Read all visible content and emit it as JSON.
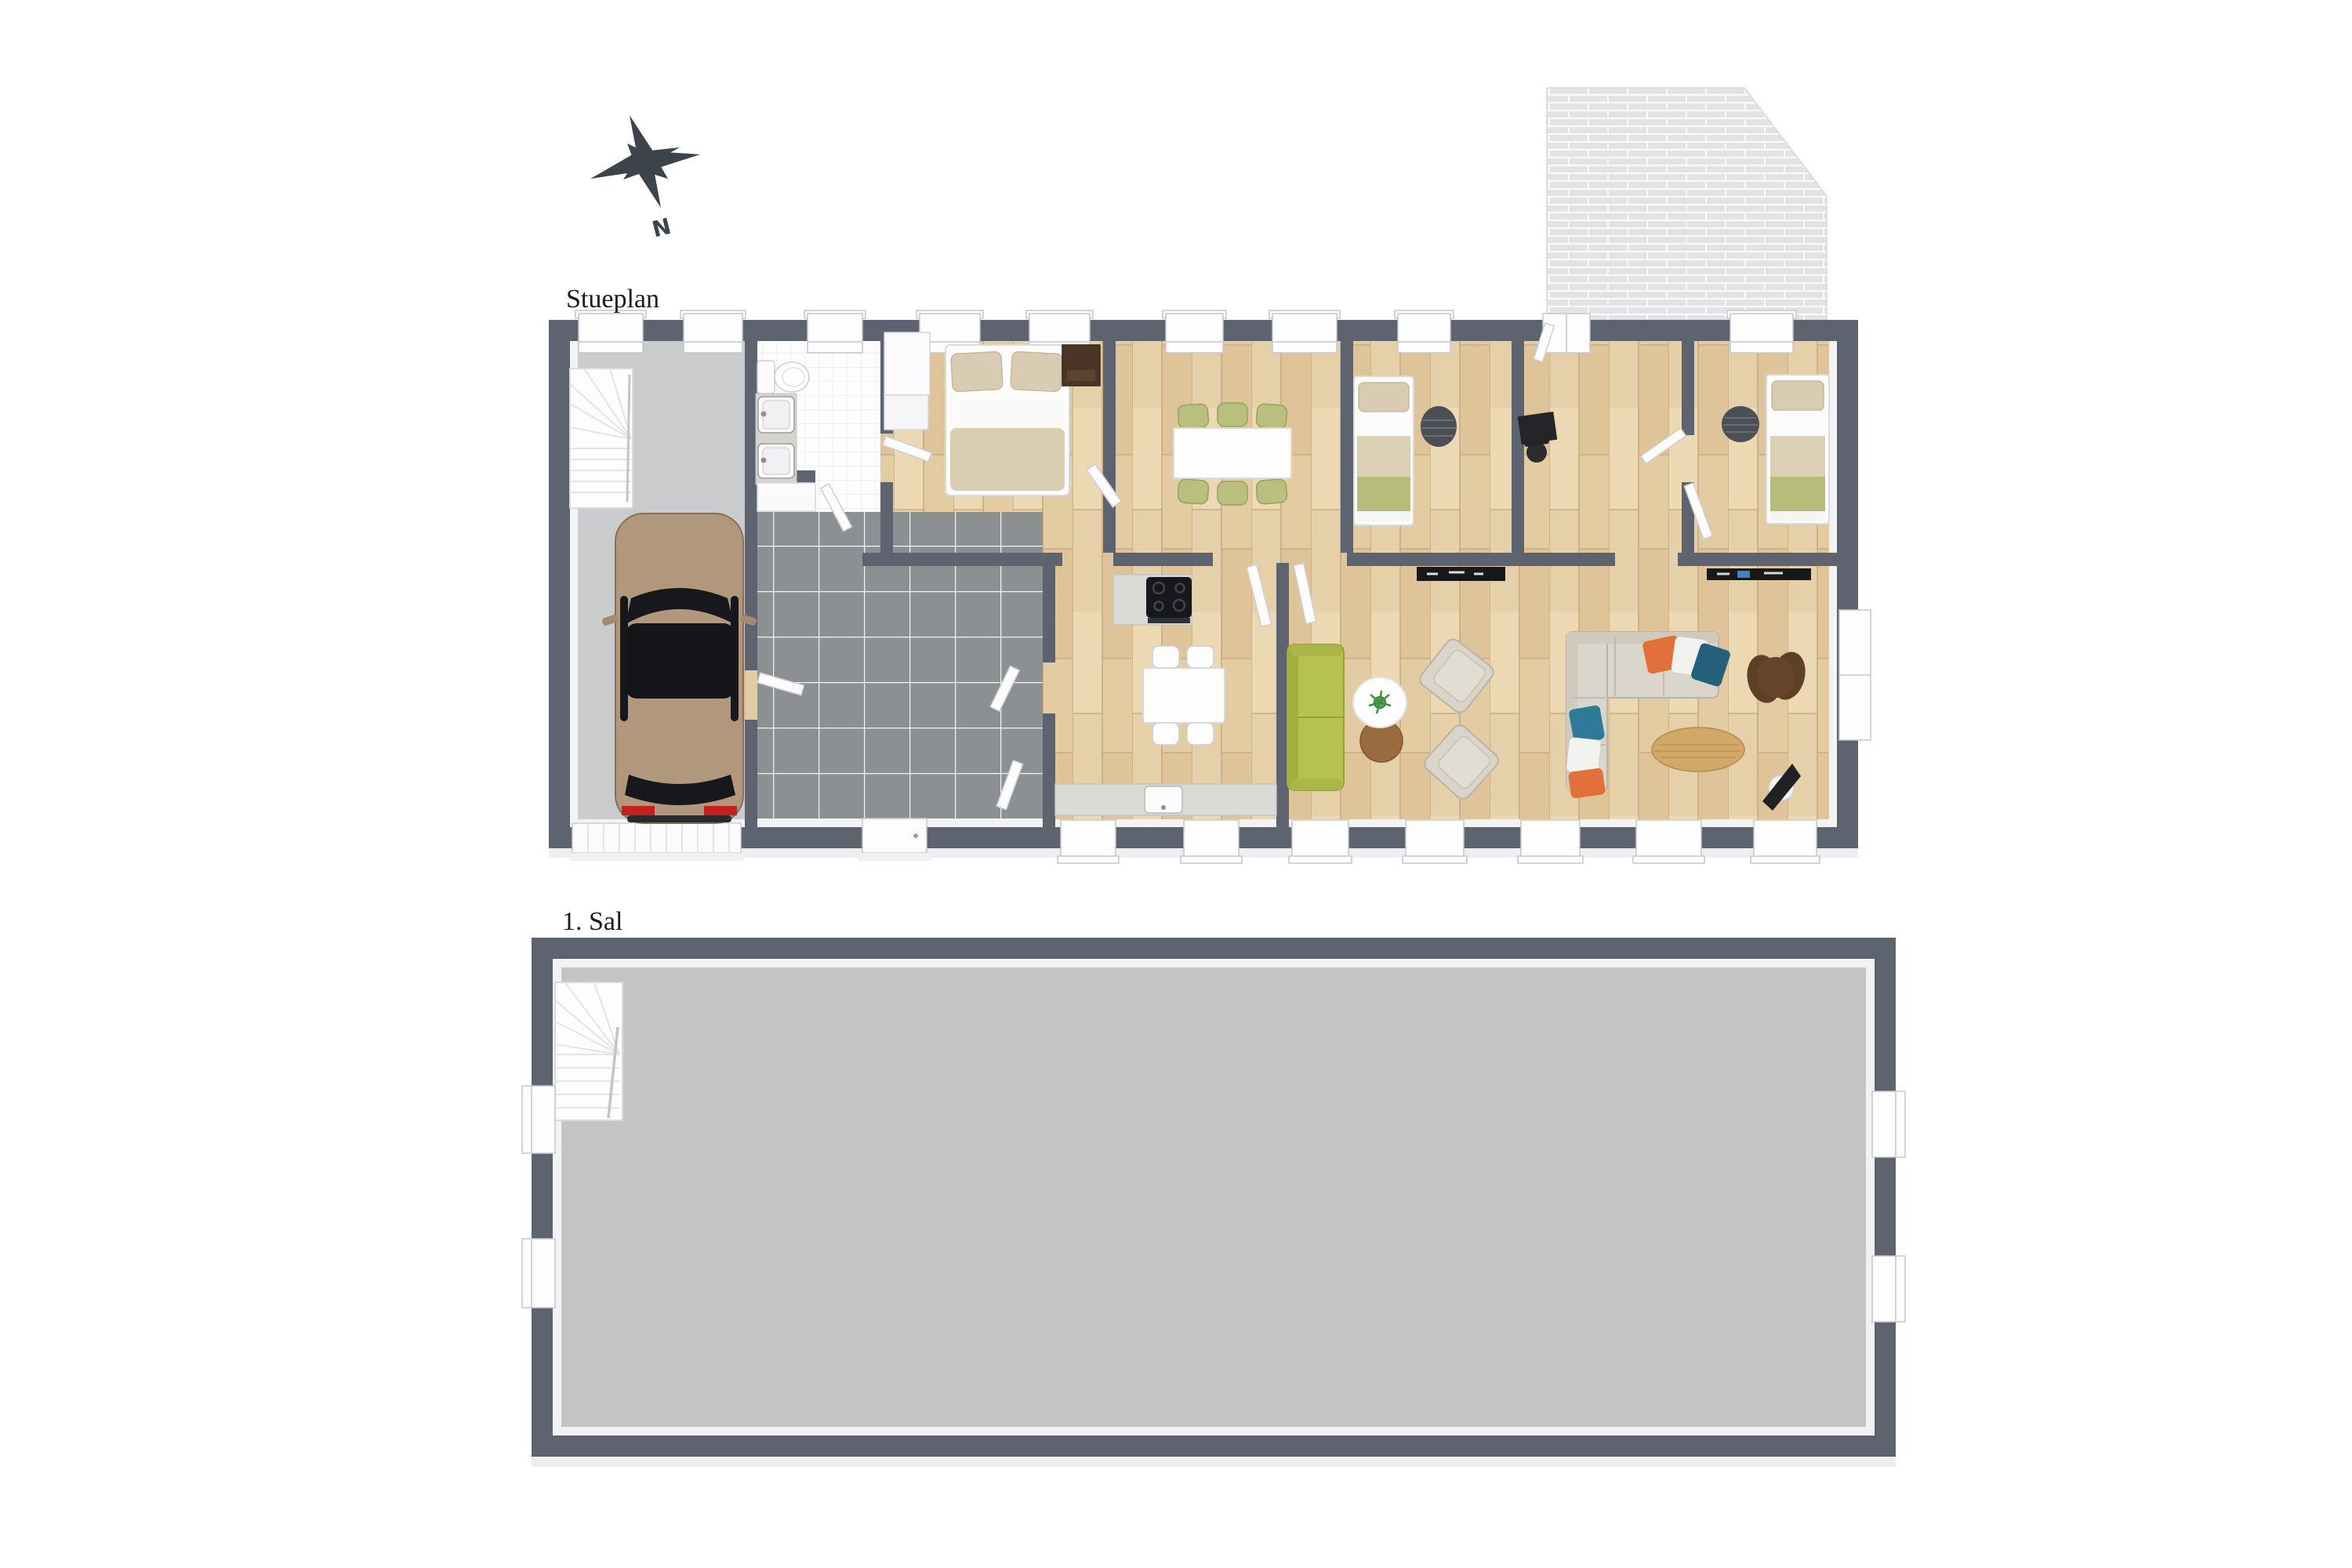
{
  "floors": [
    {
      "label": "Stueplan"
    },
    {
      "label": "1. Sal"
    }
  ],
  "compass": {
    "north_label": "N"
  },
  "icons": {
    "compass": "compass-rose-icon"
  },
  "colors": {
    "background": "#ffffff",
    "wall": "#5d6470",
    "trim": "#f2f2f4",
    "label_text": "#1b1b1b",
    "compass": "#3d434b",
    "floor_wood": "#e6d0a9",
    "floor_garage": "#c9cbcc",
    "floor_hall_tile": "#8d9093",
    "floor_bathroom": "#fdfdfe",
    "floor_first": "#c3c5c4",
    "patio_brick": "#e2e3e5",
    "sofa_green": "#b5c24e",
    "sofa_beige": "#dad6cb",
    "chair_olive": "#b9c07e",
    "bed_blanket_green": "#b6bd7b",
    "bed_beige": "#d9ccb2",
    "pillow_orange": "#e2703a",
    "pillow_teal": "#25607a",
    "rug_dark": "#4b5056",
    "rug_brown": "#5e4027",
    "coffee_table_wood": "#d2a869",
    "side_table_brown": "#9a6b3f",
    "car_body": "#b1977c",
    "car_glass": "#17181b",
    "car_taillight": "#c41f1f",
    "appliance_black": "#16181b"
  }
}
